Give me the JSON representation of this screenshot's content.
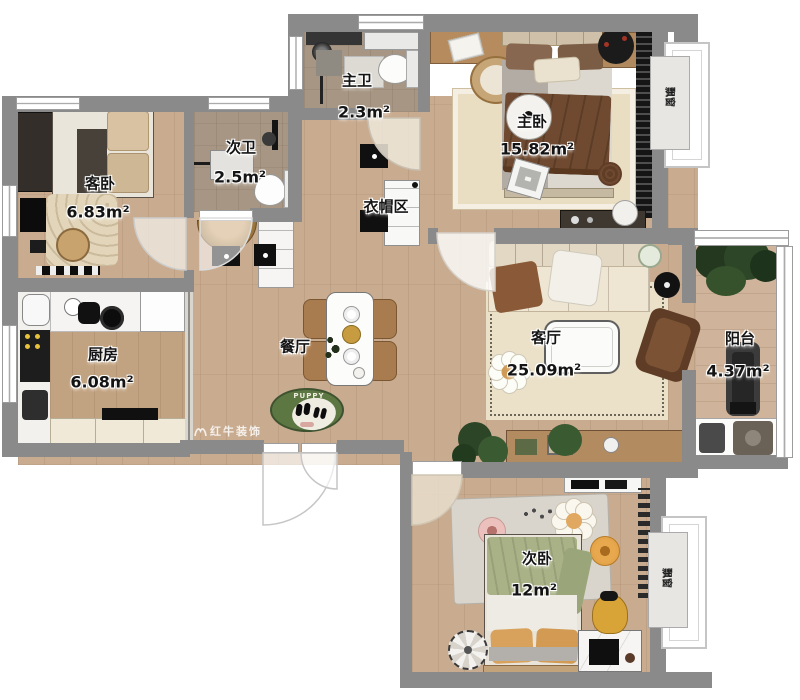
{
  "rooms": [
    {
      "name": "主卫",
      "area": "2.3m²",
      "name_pos": [
        357,
        80
      ],
      "area_pos": [
        364,
        112
      ]
    },
    {
      "name": "次卫",
      "area": "2.5m²",
      "name_pos": [
        241,
        147
      ],
      "area_pos": [
        240,
        177
      ]
    },
    {
      "name": "客卧",
      "area": "6.83m²",
      "name_pos": [
        100,
        183
      ],
      "area_pos": [
        98,
        212
      ]
    },
    {
      "name": "主卧",
      "area": "15.82m²",
      "name_pos": [
        532,
        121
      ],
      "area_pos": [
        537,
        149
      ]
    },
    {
      "name": "衣帽区",
      "area": "",
      "name_pos": [
        386,
        206
      ],
      "area_pos": null
    },
    {
      "name": "厨房",
      "area": "6.08m²",
      "name_pos": [
        103,
        354
      ],
      "area_pos": [
        102,
        382
      ]
    },
    {
      "name": "餐厅",
      "area": "",
      "name_pos": [
        295,
        346
      ],
      "area_pos": null
    },
    {
      "name": "客厅",
      "area": "25.09m²",
      "name_pos": [
        546,
        337
      ],
      "area_pos": [
        544,
        370
      ]
    },
    {
      "name": "阳台",
      "area": "4.37m²",
      "name_pos": [
        740,
        338
      ],
      "area_pos": [
        738,
        371
      ]
    },
    {
      "name": "次卧",
      "area": "12m²",
      "name_pos": [
        537,
        558
      ],
      "area_pos": [
        534,
        590
      ]
    }
  ],
  "bay_windows": [
    {
      "label": "飘窗",
      "pos": [
        671,
        97
      ]
    },
    {
      "label": "飘窗",
      "pos": [
        668,
        578
      ]
    }
  ],
  "watermark": {
    "text": "红牛装饰"
  },
  "dining": {
    "rug_text": "PUPPY"
  },
  "colors": {
    "wall": "#8a8a8a",
    "wood_floor": "#c9ac90",
    "bath_tile": "#a79683",
    "kitchen_floor": "#c2a381",
    "living_rug": "#ebe0c8",
    "sofa": "#e6dcc8",
    "blanket_brown": "#6f4a30",
    "bed_green": "#a9b287",
    "accent_orange": "#d9a25c",
    "puppy_rug_green": "#5d7743",
    "chair_wood": "#a97c4f"
  }
}
